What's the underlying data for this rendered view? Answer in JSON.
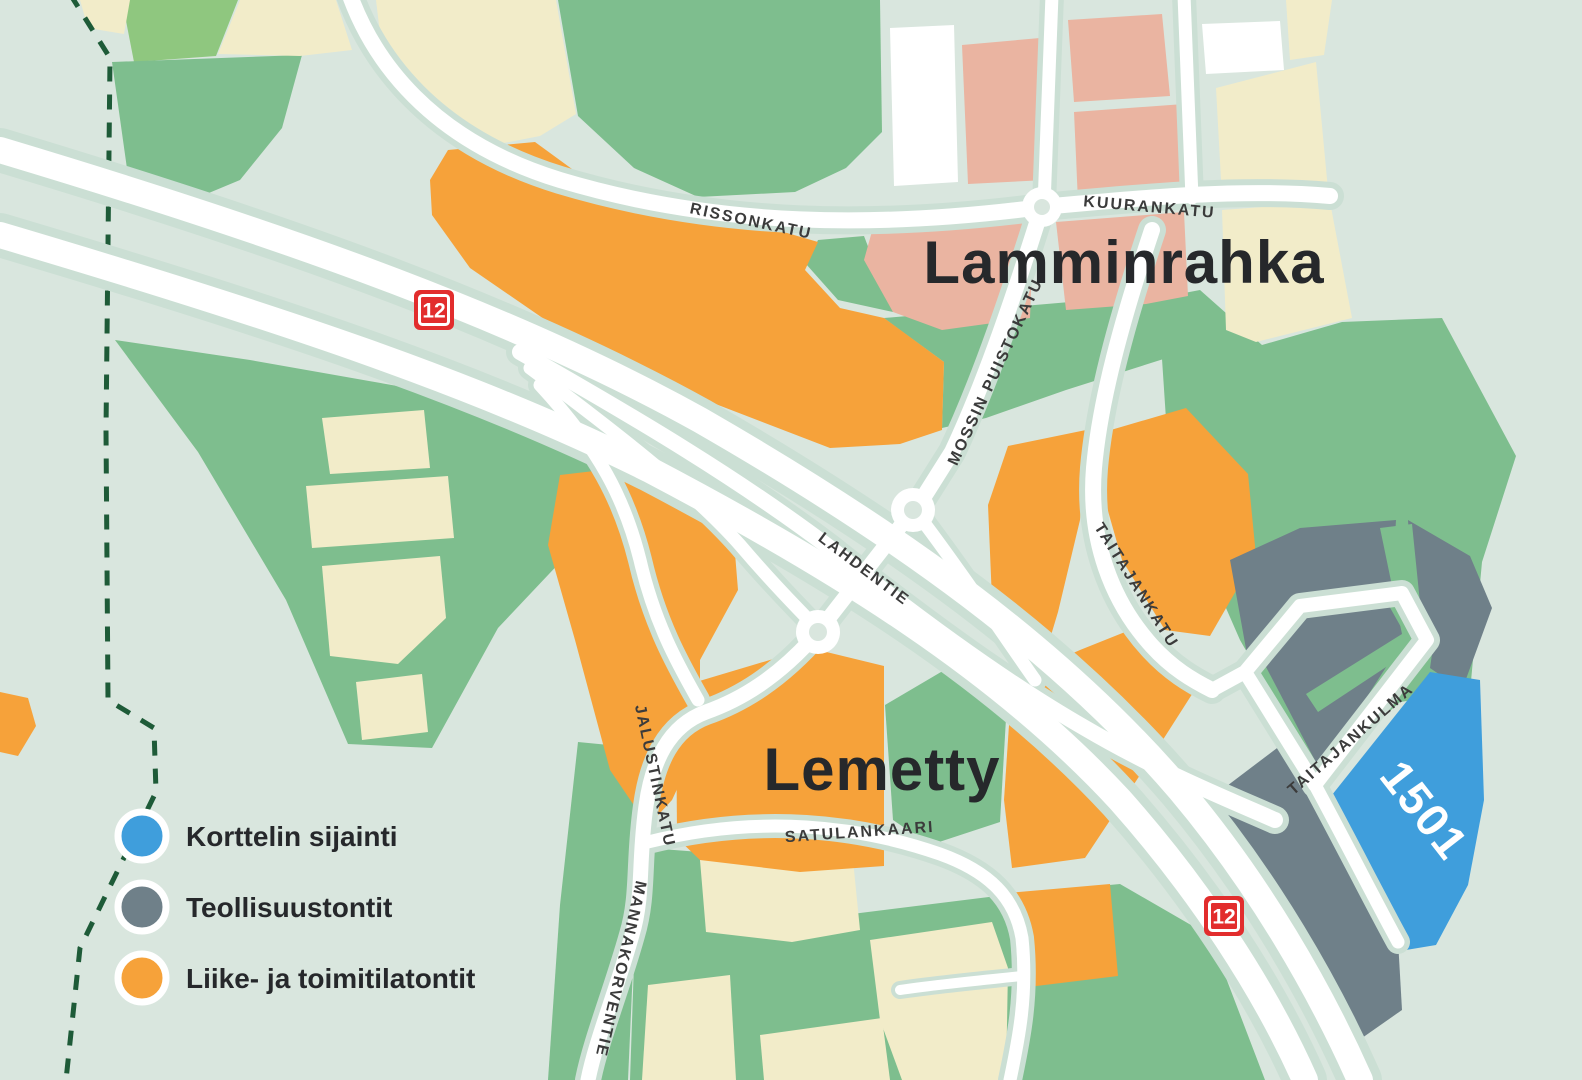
{
  "districts": [
    {
      "name": "Lamminrahka"
    },
    {
      "name": "Lemetty"
    }
  ],
  "streets": [
    "RISSONKATU",
    "KUURANKATU",
    "MOSSIN PUISTOKATU",
    "LAHDENTIE",
    "TAITAJANKATU",
    "TAITAJANKULMA",
    "JALUSTINKATU",
    "MANNAKORVENTIE",
    "SATULANKAARI"
  ],
  "plot": {
    "number": "1501"
  },
  "route_badges": [
    {
      "number": "12"
    },
    {
      "number": "12"
    }
  ],
  "legend": {
    "items": [
      {
        "label": "Korttelin sijainti",
        "color": "#3f9edc"
      },
      {
        "label": "Teollisuustontit",
        "color": "#76838b"
      },
      {
        "label": "Liike- ja toimitilatontit",
        "color": "#f5a12d"
      }
    ]
  },
  "colors": {
    "map_background": "#d9e6de",
    "green": "#7ebe8e",
    "bright_green": "#8fc77f",
    "cream": "#f2ecc9",
    "salmon": "#eab4a1",
    "orange": "#f6a23a",
    "industrial_gray": "#6f8089",
    "plot_blue": "#3f9edc",
    "road_white": "#ffffff",
    "road_casing": "#cbdfd4",
    "boundary_green": "#1e5b38",
    "badge_red": "#e22d2d",
    "text_dark": "#26282b",
    "street_text": "#3b3b3b"
  }
}
